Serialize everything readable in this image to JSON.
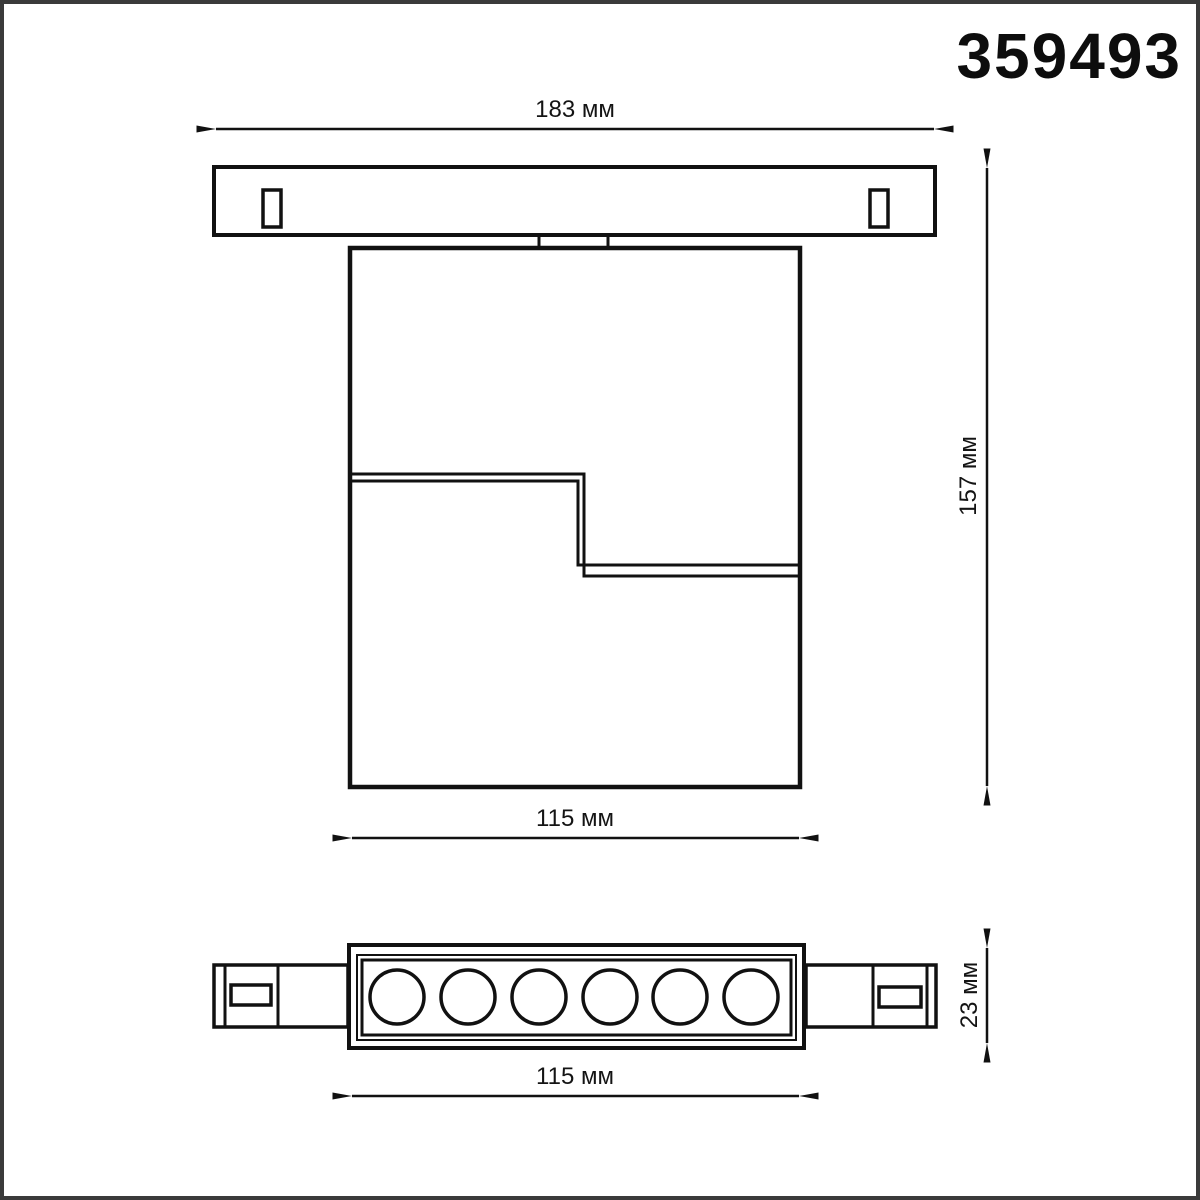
{
  "product": {
    "code": "359493"
  },
  "dimensions": {
    "track_length": "183 мм",
    "overall_height": "157 мм",
    "body_width": "115 мм",
    "head_thickness": "23 мм",
    "head_length": "115 мм"
  },
  "drawing": {
    "led_lens_count": 6,
    "colors": {
      "line": "#111111",
      "frame": "#3a3a3a",
      "background": "#ffffff"
    }
  }
}
